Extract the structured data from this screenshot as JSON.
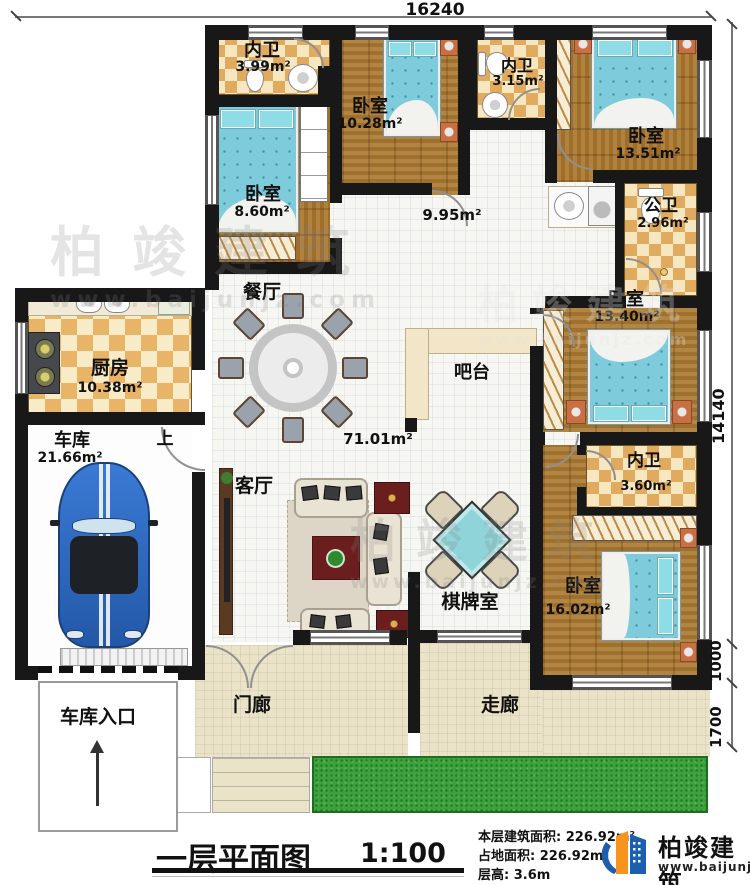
{
  "dimensions": {
    "width_top": "16240",
    "height_right": "14140",
    "seg_1000": "1000",
    "seg_1700": "1700"
  },
  "rooms": {
    "bath_a": {
      "name": "内卫",
      "area": "3.99m²"
    },
    "bedroom_a": {
      "name": "卧室",
      "area": "10.28m²"
    },
    "bath_b": {
      "name": "内卫",
      "area": "3.15m²"
    },
    "bedroom_b": {
      "name": "卧室",
      "area": "13.51m²"
    },
    "bedroom_c": {
      "name": "卧室",
      "area": "8.60m²"
    },
    "hallway": {
      "area": "9.95m²"
    },
    "public_bath": {
      "name": "公卫",
      "area": "2.96m²"
    },
    "dining": {
      "name": "餐厅"
    },
    "kitchen": {
      "name": "厨房",
      "area": "10.38m²"
    },
    "bar": {
      "name": "吧台"
    },
    "bedroom_d": {
      "name": "卧室",
      "area": "13.40m²"
    },
    "garage": {
      "name": "车库",
      "area": "21.66m²"
    },
    "stairs": {
      "label": "上"
    },
    "living_open": {
      "area": "71.01m²"
    },
    "living": {
      "name": "客厅"
    },
    "bath_c": {
      "name": "内卫",
      "area": "3.60m²"
    },
    "chess": {
      "name": "棋牌室"
    },
    "bedroom_e": {
      "name": "卧室",
      "area": "16.02m²"
    },
    "porch": {
      "name": "门廊"
    },
    "corridor": {
      "name": "走廊"
    },
    "garage_entry": {
      "name": "车库入口"
    }
  },
  "title_block": {
    "title": "一层平面图",
    "scale": "1:100",
    "stat_area_floor": "本层建筑面积: 226.92m²",
    "stat_area_land": "占地面积: 226.92m²",
    "stat_height": "层高: 3.6m"
  },
  "brand": {
    "name": "柏竣建筑",
    "url": "www.baijunjz.com"
  },
  "watermark": {
    "name": "柏竣建筑",
    "url": "www.baijunjz.com"
  },
  "colors": {
    "wall": "#181818",
    "wood_floor": "#a97a33",
    "checker_dark": "#e0ab5e",
    "checker_light": "#f6e7c0",
    "tile_white": "#f6f6f3",
    "tile_beige": "#ebe3c8",
    "bed_blue": "#7ecbdc",
    "grass_green": "#3da13d",
    "car_blue": "#2b6bc4",
    "logo_blue": "#1c5fae",
    "logo_orange": "#f7941d"
  }
}
